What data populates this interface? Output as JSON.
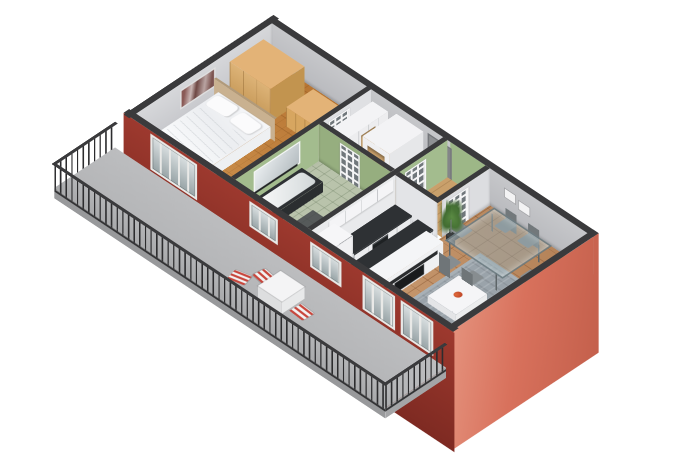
{
  "meta": {
    "title": "3D isometric cutaway floor plan of a one-bedroom apartment with balcony",
    "view": "axonometric cutaway, walls cut at door height",
    "background": "#ffffff"
  },
  "colors": {
    "cap": "#3a3a3c",
    "extRed": "#9d392e",
    "extRedDeep": "#7e2a22",
    "salmon": "#d8715c",
    "salmonLight": "#e4917c",
    "wallGray": "#c6c7ca",
    "wallLight": "#d6d7da",
    "green": "#a3bc8e",
    "greenShade": "#96ae7f",
    "parquet": "#c07c36",
    "wood": "#c9a06b",
    "bathFloor": "#b9c3ab",
    "kitchenFloor": "#ced2d4",
    "tile": "#bd8a5e",
    "balcFloor": "#b5b6b8",
    "rail": "#2c2c2e",
    "counterTop": "#2e3134",
    "cabinetWhite": "#eff0f2",
    "woodLight": "#d7a660",
    "chairGray": "#878d90",
    "rugGray": "#9aa3aa",
    "doorGray": "#8f9194",
    "accent": "#c8463c"
  },
  "rooms": {
    "bedroom": {
      "name": "Bedroom",
      "floor": "orange-brown parquet",
      "walls": "light gray"
    },
    "bathroom": {
      "name": "Bathroom",
      "floor": "pale sage tile",
      "walls": "sage green"
    },
    "hallway": {
      "name": "Hallway",
      "floor": "light wood",
      "walls": "gray and white"
    },
    "kitchen": {
      "name": "Kitchen",
      "floor": "gray tile",
      "walls": "white"
    },
    "vestibule": {
      "name": "Entry vestibule",
      "floor": "light wood",
      "walls": "sage green"
    },
    "living": {
      "name": "Living / dining room",
      "floor": "terracotta tile",
      "walls": "gray"
    },
    "balcony": {
      "name": "Balcony",
      "floor": "concrete gray",
      "railing": "dark metal balusters"
    }
  },
  "furniture": {
    "bedroom": [
      "double bed with white duvet and two pillows",
      "tan headboard panel",
      "light-wood wardrobe",
      "light-wood dresser",
      "framed wall picture"
    ],
    "bathroom": [
      "bathtub with dark surround",
      "wall mirror with shelf",
      "dark bath mat"
    ],
    "hallway": [
      "white closet",
      "white open wardrobe niche"
    ],
    "kitchen": [
      "white counter with dark top",
      "built-in dark oven",
      "tall white cabinet",
      "white upper cabinets"
    ],
    "living": [
      "glass dining table",
      "six gray chairs",
      "gray rug",
      "white coffee table with red bowl",
      "white media wall with TV",
      "potted plant",
      "two small wall frames"
    ],
    "balcony": [
      "white bistro table",
      "three red-white striped folding chairs"
    ]
  },
  "openings": {
    "entry_door": "gray apartment entry door on rear wall",
    "glazed_doors": "four white doors with dark glass panes",
    "sw_windows": [
      "bedroom balcony window",
      "bathroom window",
      "kitchen window",
      "living room window 1",
      "living room window 2"
    ]
  }
}
